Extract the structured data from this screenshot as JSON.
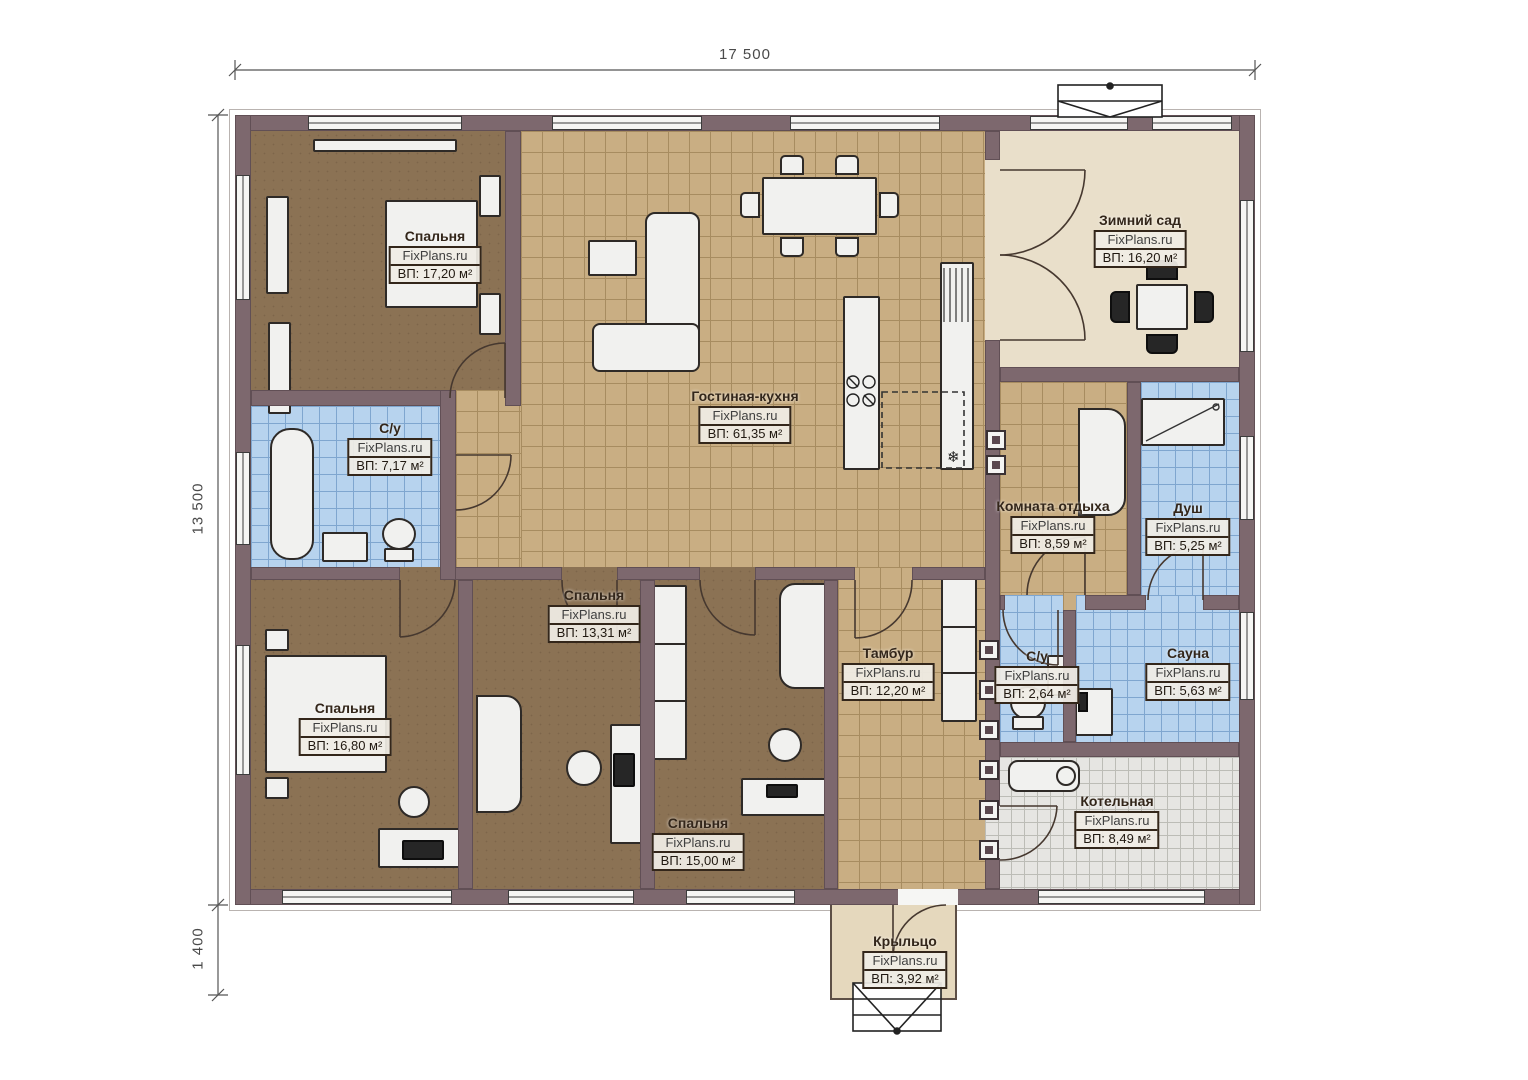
{
  "brand": "FixPlans.ru",
  "dimensions": {
    "top": "17 500",
    "left": "13 500",
    "bottom_left": "1 400"
  },
  "rooms": [
    {
      "name": "Спальня",
      "area": "ВП: 17,20 м²"
    },
    {
      "name": "Гостиная-кухня",
      "area": "ВП: 61,35 м²"
    },
    {
      "name": "Зимний сад",
      "area": "ВП: 16,20 м²"
    },
    {
      "name": "С/у",
      "area": "ВП: 7,17 м²"
    },
    {
      "name": "Комната отдыха",
      "area": "ВП: 8,59 м²"
    },
    {
      "name": "Душ",
      "area": "ВП: 5,25 м²"
    },
    {
      "name": "Спальня",
      "area": "ВП: 13,31 м²"
    },
    {
      "name": "Спальня",
      "area": "ВП: 16,80 м²"
    },
    {
      "name": "Спальня",
      "area": "ВП: 15,00 м²"
    },
    {
      "name": "Тамбур",
      "area": "ВП: 12,20 м²"
    },
    {
      "name": "С/у",
      "area": "ВП: 2,64 м²"
    },
    {
      "name": "Сауна",
      "area": "ВП: 5,63 м²"
    },
    {
      "name": "Котельная",
      "area": "ВП: 8,49 м²"
    },
    {
      "name": "Крыльцо",
      "area": "ВП: 3,92 м²"
    }
  ],
  "icons": {
    "freezer_icon": "❄"
  },
  "colors": {
    "wall": "#7d686e",
    "floor_living": "#c9ae83",
    "floor_bedroom": "#8b7254",
    "floor_bath": "#b7d3ee",
    "floor_garden": "#e9dfca",
    "floor_boiler": "#e6e5e2",
    "floor_porch": "#e5d8bd"
  }
}
